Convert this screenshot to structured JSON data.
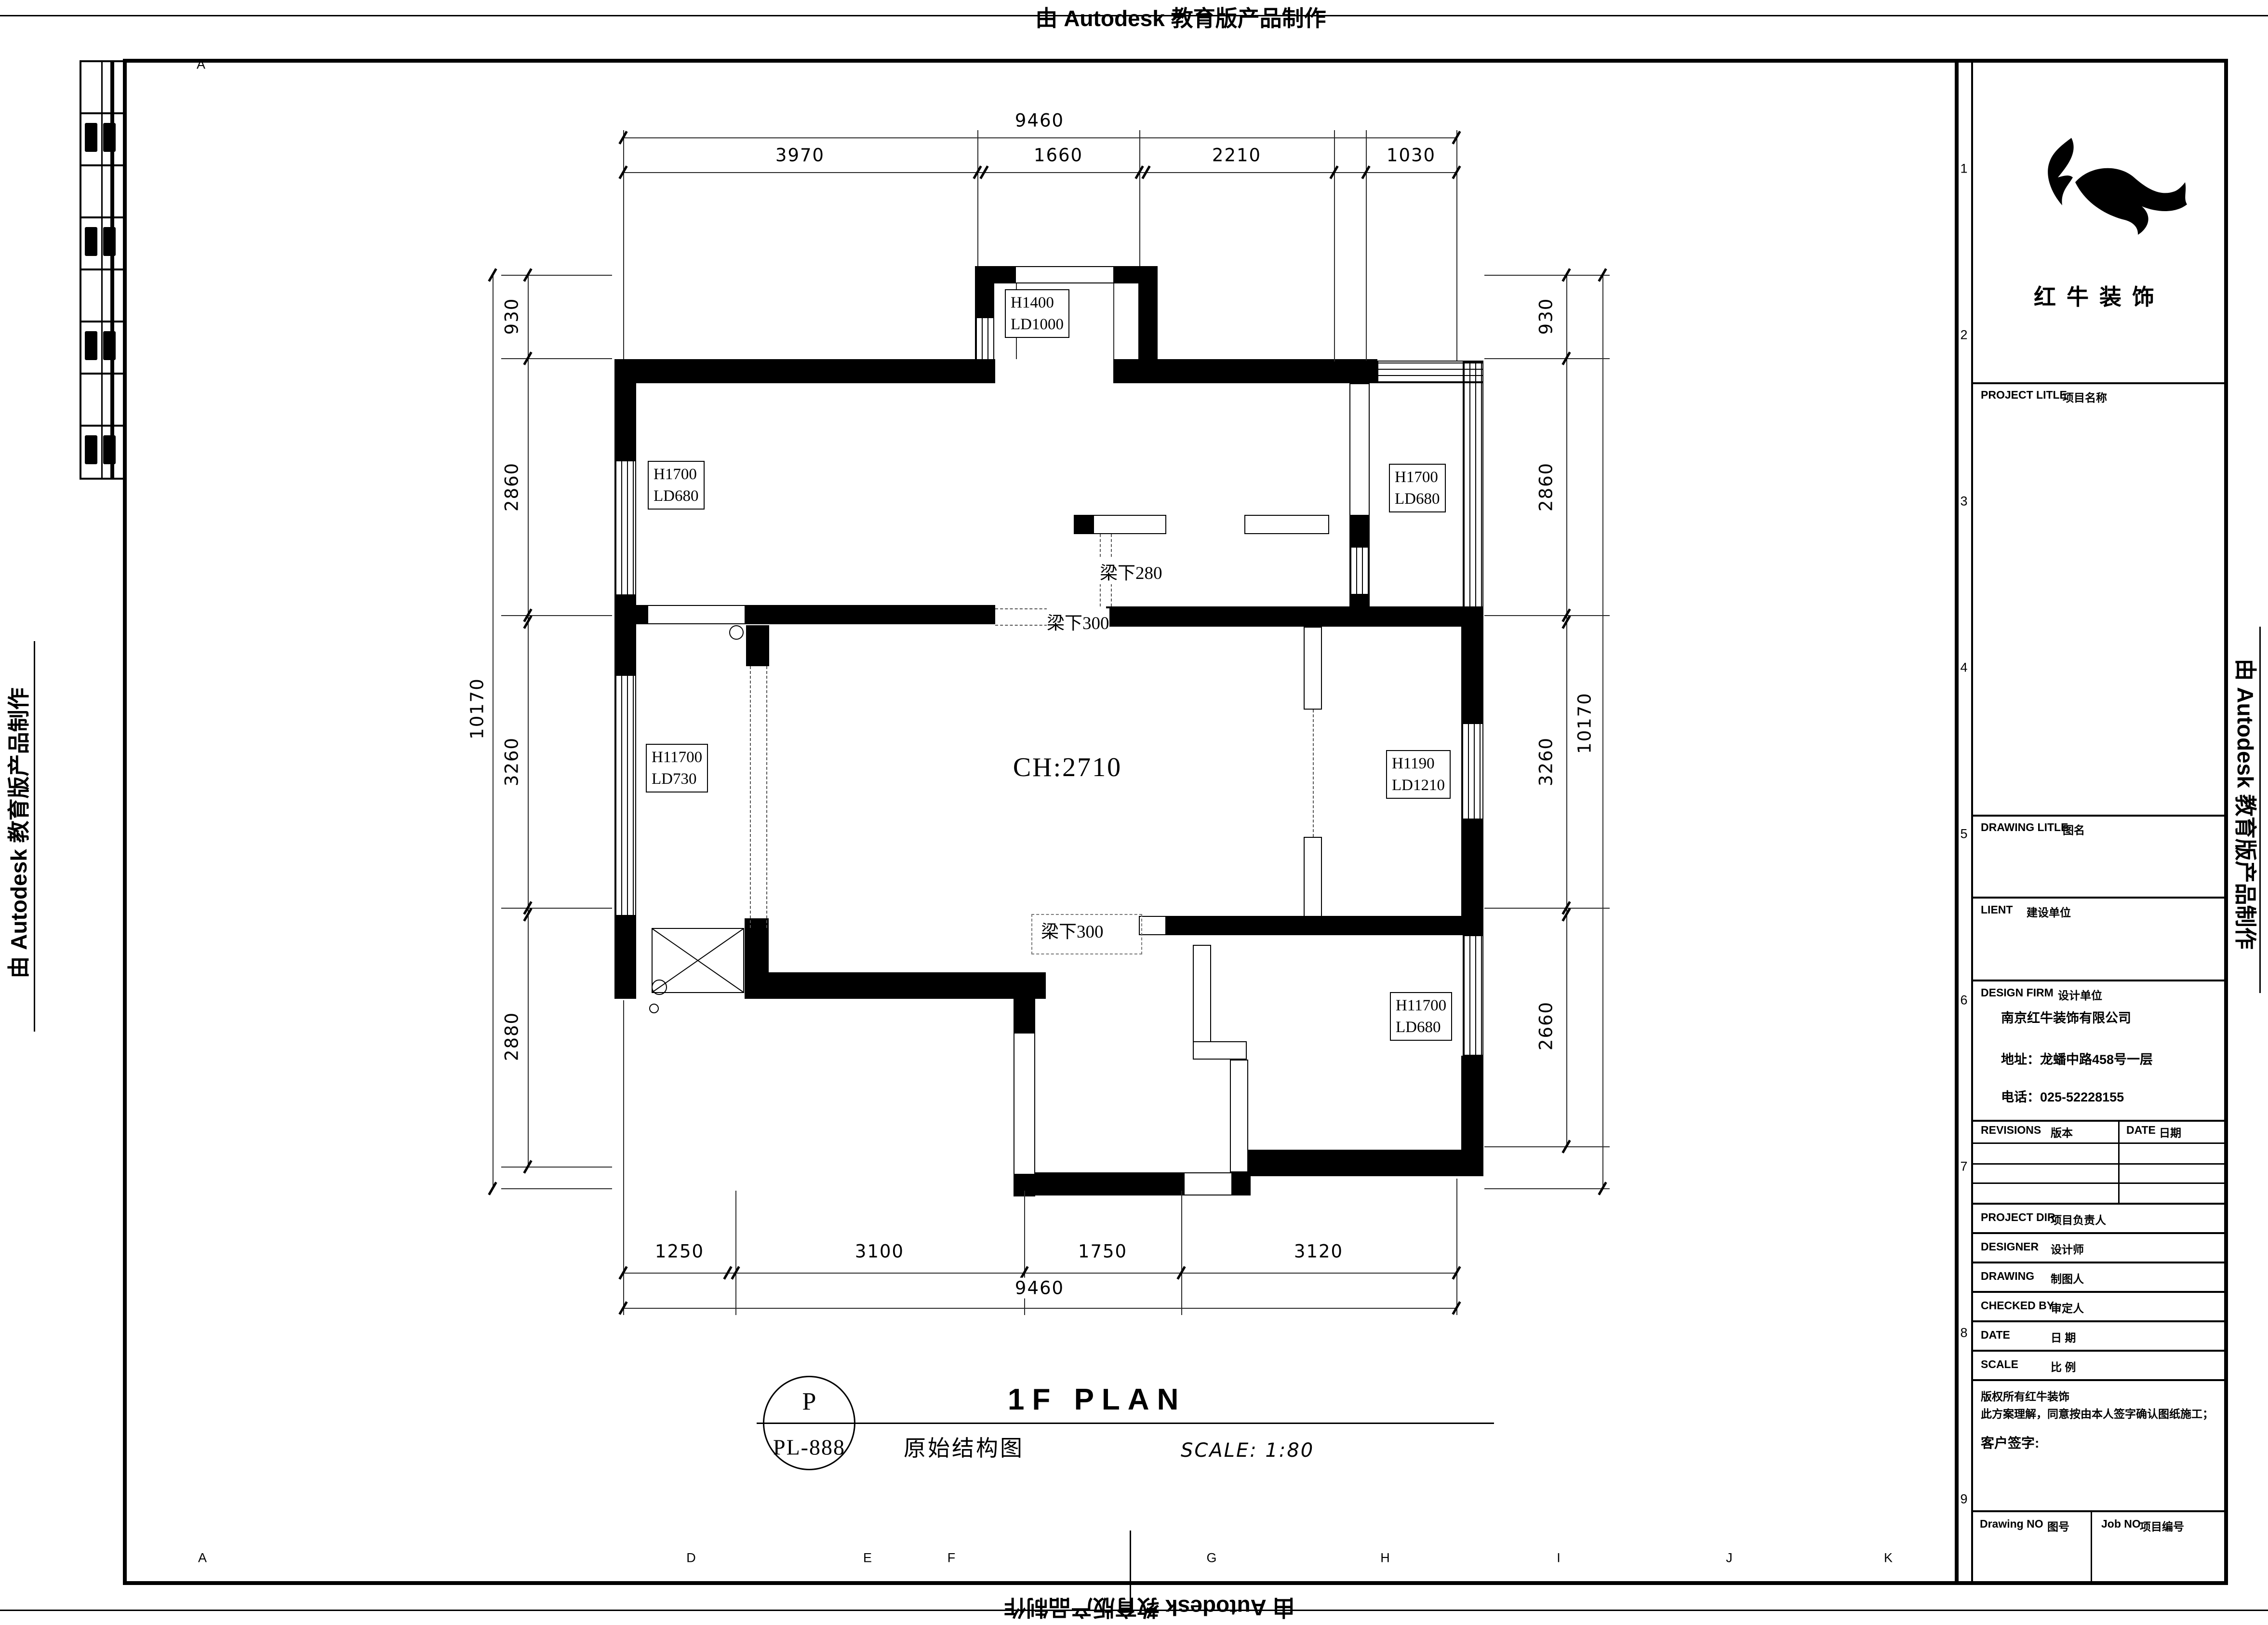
{
  "stamp": {
    "text": "由 Autodesk 教育版产品制作"
  },
  "plan": {
    "ceiling_height": "CH:2710",
    "room_tags": [
      [
        "H1400",
        "LD1000"
      ],
      [
        "H1700",
        "LD680"
      ],
      [
        "H1700",
        "LD680"
      ],
      [
        "H11700",
        "LD730"
      ],
      [
        "H1190",
        "LD1210"
      ],
      [
        "H11700",
        "LD680"
      ]
    ],
    "beam_notes": [
      "梁下280",
      "梁下300",
      "梁下300"
    ]
  },
  "dimensions": {
    "top": {
      "total": "9460",
      "segments": [
        "3970",
        "1660",
        "2210",
        "1030"
      ]
    },
    "bottom": {
      "total": "9460",
      "segments": [
        "1250",
        "3100",
        "1750",
        "3120"
      ]
    },
    "left": {
      "total": "10170",
      "segments": [
        "930",
        "2860",
        "3260",
        "2880"
      ]
    },
    "right": {
      "total": "10170",
      "segments": [
        "930",
        "2860",
        "3260",
        "2660"
      ]
    }
  },
  "title_bar": {
    "bubble_top": "P",
    "bubble_bottom": "PL-888",
    "title": "1F PLAN",
    "subtitle": "原始结构图",
    "scale": "SCALE: 1:80"
  },
  "title_block": {
    "brand": "红牛装饰",
    "fields": {
      "project_title": {
        "en": "PROJECT LITLE",
        "cn": "项目名称"
      },
      "drawing_title": {
        "en": "DRAWING LITLE",
        "cn": "图名"
      },
      "client": {
        "en": "LIENT",
        "cn": "建设单位"
      },
      "design_firm": {
        "en": "DESIGN FIRM",
        "cn": "设计单位"
      }
    },
    "company": {
      "name": "南京红牛装饰有限公司",
      "address": "地址：龙蟠中路458号一层",
      "phone": "电话：025-52228155"
    },
    "revisions": {
      "left_en": "REVISIONS",
      "left_cn": "版本",
      "right_en": "DATE",
      "right_cn": "日期"
    },
    "staff": [
      {
        "en": "PROJECT DIR",
        "cn": "项目负责人"
      },
      {
        "en": "DESIGNER",
        "cn": "设计师"
      },
      {
        "en": "DRAWING",
        "cn": "制图人"
      },
      {
        "en": "CHECKED BY",
        "cn": "审定人"
      },
      {
        "en": "DATE",
        "cn": "日  期"
      },
      {
        "en": "SCALE",
        "cn": "比  例"
      }
    ],
    "notes": [
      "版权所有红牛装饰",
      "此方案理解，同意按由本人签字确认图纸施工；"
    ],
    "client_sign": "客户签字:",
    "drawing_no": {
      "en": "Drawing NO",
      "cn": "图号"
    },
    "job_no": {
      "en": "Job NO",
      "cn": "项目编号"
    }
  },
  "grid": {
    "letters": [
      "A",
      "D",
      "E",
      "F",
      "G",
      "H",
      "I",
      "J",
      "K"
    ],
    "numbers": [
      "1",
      "2",
      "3",
      "4",
      "5",
      "6",
      "7",
      "8",
      "9"
    ],
    "corner": "A"
  }
}
